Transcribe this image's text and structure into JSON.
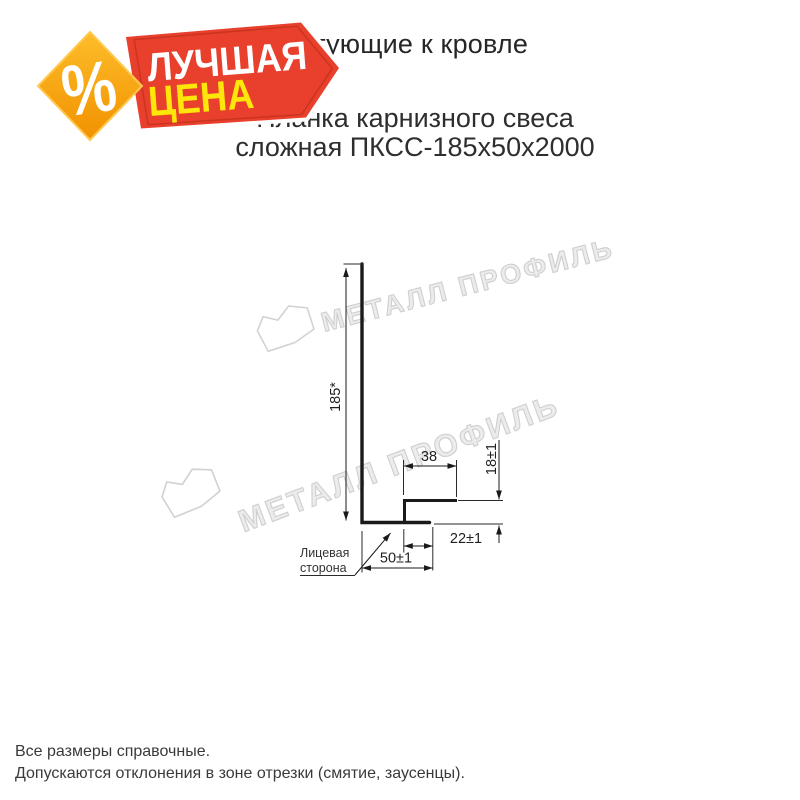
{
  "badge": {
    "percent": "%",
    "line1": "ЛУЧШАЯ",
    "line2": "ЦЕНА",
    "colors": {
      "red": "#e8402c",
      "red_stripe": "#c8321e",
      "orange_light": "#fdbd2a",
      "orange_dark": "#f29100",
      "yellow_text": "#ffe60a",
      "white_text": "#ffffff"
    }
  },
  "header": {
    "title": "Комплектующие к кровле",
    "subtitle_line1": "Планка карнизного свеса",
    "subtitle_line2": "сложная ПКСС-185х50х2000"
  },
  "watermark": {
    "text": "МЕТАЛЛ ПРОФИЛЬ",
    "color": "#d9d9d9"
  },
  "drawing": {
    "dimensions": {
      "height": "185*",
      "hook_width": "38",
      "hook_height": "18±1",
      "hem_return": "22±1",
      "bottom_width": "50±1"
    },
    "face_label_line1": "Лицевая",
    "face_label_line2": "сторона",
    "line_color": "#1a1a1a"
  },
  "footer": {
    "line1": "Все размеры справочные.",
    "line2": "Допускаются отклонения в зоне отрезки (смятие, заусенцы)."
  }
}
